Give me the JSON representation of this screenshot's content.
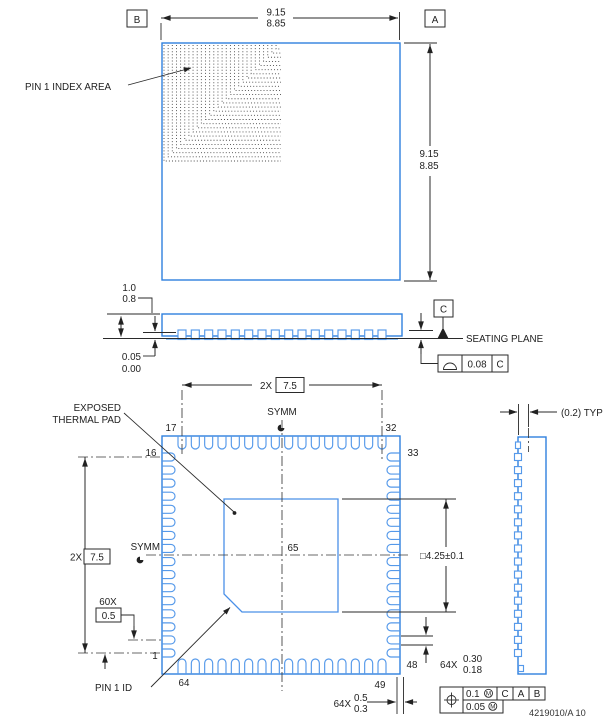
{
  "labels": {
    "pin1_index_area": "PIN 1 INDEX AREA",
    "exposed_line1": "EXPOSED",
    "exposed_line2": "THERMAL PAD",
    "symm": "SYMM",
    "seating_plane": "SEATING PLANE",
    "pin1_id": "PIN 1 ID",
    "typ_offset": "(0.2) TYP",
    "doc_number": "4219010/A   10"
  },
  "datums": {
    "a": "A",
    "b": "B",
    "c": "C"
  },
  "dims": {
    "body_max": "9.15",
    "body_min": "8.85",
    "height_max": "1.0",
    "height_min": "0.8",
    "standoff_max": "0.05",
    "standoff_min": "0.00",
    "flatness_tol": "0.08",
    "count_2x": "2X",
    "pitch_span": "7.5",
    "count_60x": "60X",
    "pitch": "0.5",
    "pad_size": "□4.25±0.1",
    "count_64x": "64X",
    "lead_width_max": "0.30",
    "lead_width_min": "0.18",
    "lead_len_max": "0.5",
    "lead_len_min": "0.3",
    "pos_tol": "0.1",
    "pos_tol2": "0.05",
    "mmc": "M"
  },
  "pins": {
    "p1": "1",
    "p16": "16",
    "p17": "17",
    "p32": "32",
    "p33": "33",
    "p48": "48",
    "p49": "49",
    "p64": "64",
    "p65": "65"
  }
}
